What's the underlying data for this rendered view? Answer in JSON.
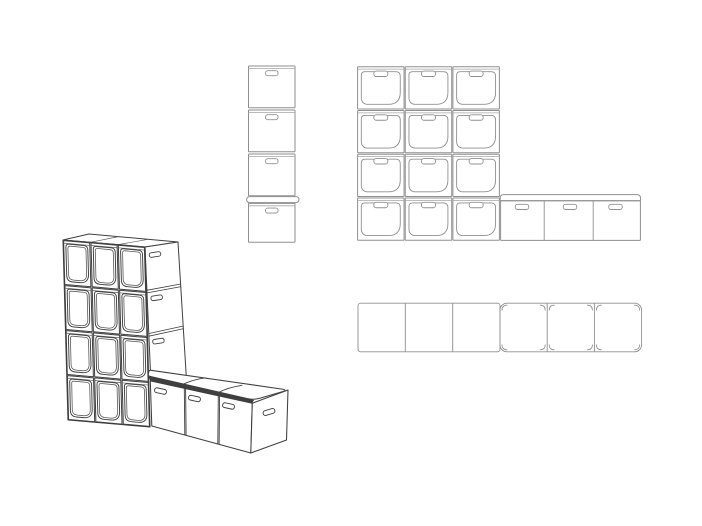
{
  "page": {
    "width": 702,
    "height": 526,
    "background_color": "#ffffff",
    "description": "Technical line drawing of modular cube storage unit with bench: one perspective view and three orthographic views, no text labels"
  },
  "palette": {
    "detail_line": "#8f8f8f",
    "detail_line_soft": "#a6a6a6",
    "iso_line": "#3f3f3f",
    "iso_line_soft": "#5a5a5a",
    "lid_edge_fill": "#3f3f3f",
    "surface_fill": "#ffffff"
  },
  "views": {
    "isometric": {
      "label": "perspective-view",
      "x": 55,
      "y": 230,
      "width": 250,
      "height": 235,
      "wall": {
        "rows": 4,
        "columns": 3,
        "open_bins": 12,
        "side_handle_slots": 4,
        "top_seams": 2
      },
      "bench": {
        "boxes": 3,
        "front_handle_slots": 3,
        "end_handle_slots": 1,
        "lid_seams": 2
      }
    },
    "side_elevation": {
      "label": "side-elevation",
      "x": 246,
      "y": 64,
      "width": 54,
      "height": 182,
      "stacked_boxes": 4,
      "handle_slots": 4,
      "lid_above_bottom_box": true
    },
    "front_elevation": {
      "label": "front-elevation",
      "x": 355,
      "y": 62,
      "width": 290,
      "height": 184,
      "wall": {
        "rows": 4,
        "columns": 3,
        "open_bins": 12
      },
      "bench": {
        "boxes": 3,
        "handle_slots": 3,
        "lid": true
      }
    },
    "plan": {
      "label": "plan-view",
      "x": 356,
      "y": 300,
      "width": 290,
      "height": 56,
      "wall_cells": 3,
      "bench_lid_sections": 3
    }
  }
}
